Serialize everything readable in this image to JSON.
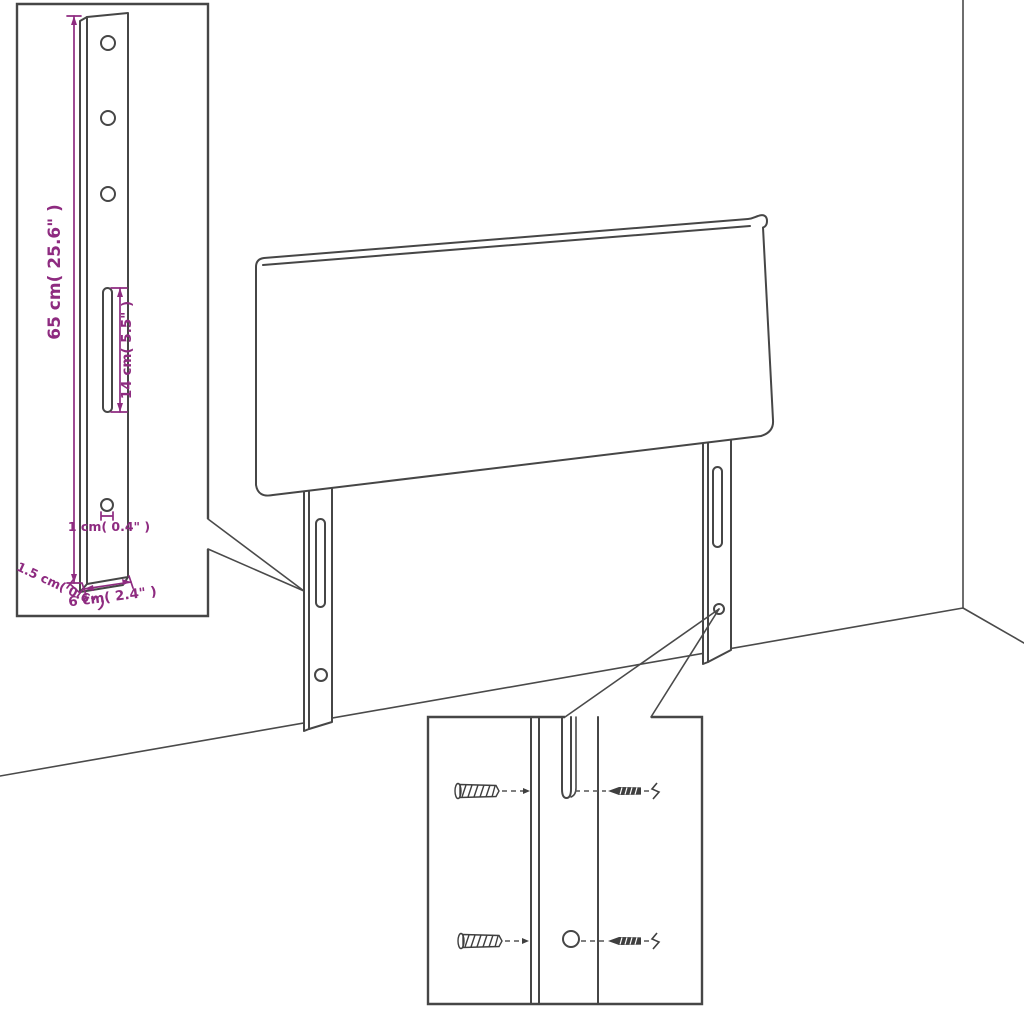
{
  "diagram": {
    "kind": "furniture-assembly-line-drawing",
    "colors": {
      "line": "#464646",
      "dimension_accent": "#8e2b80",
      "background": "#ffffff"
    },
    "annotations": {
      "bracket_height": "65 cm( 25.6\" )",
      "slot_length": "14 cm( 5.5\" )",
      "hole_size": "1 cm( 0.4\" )",
      "bracket_depth": "1.5 cm( 0.6\" )",
      "bracket_width": "6 cm( 2.4\" )"
    }
  }
}
